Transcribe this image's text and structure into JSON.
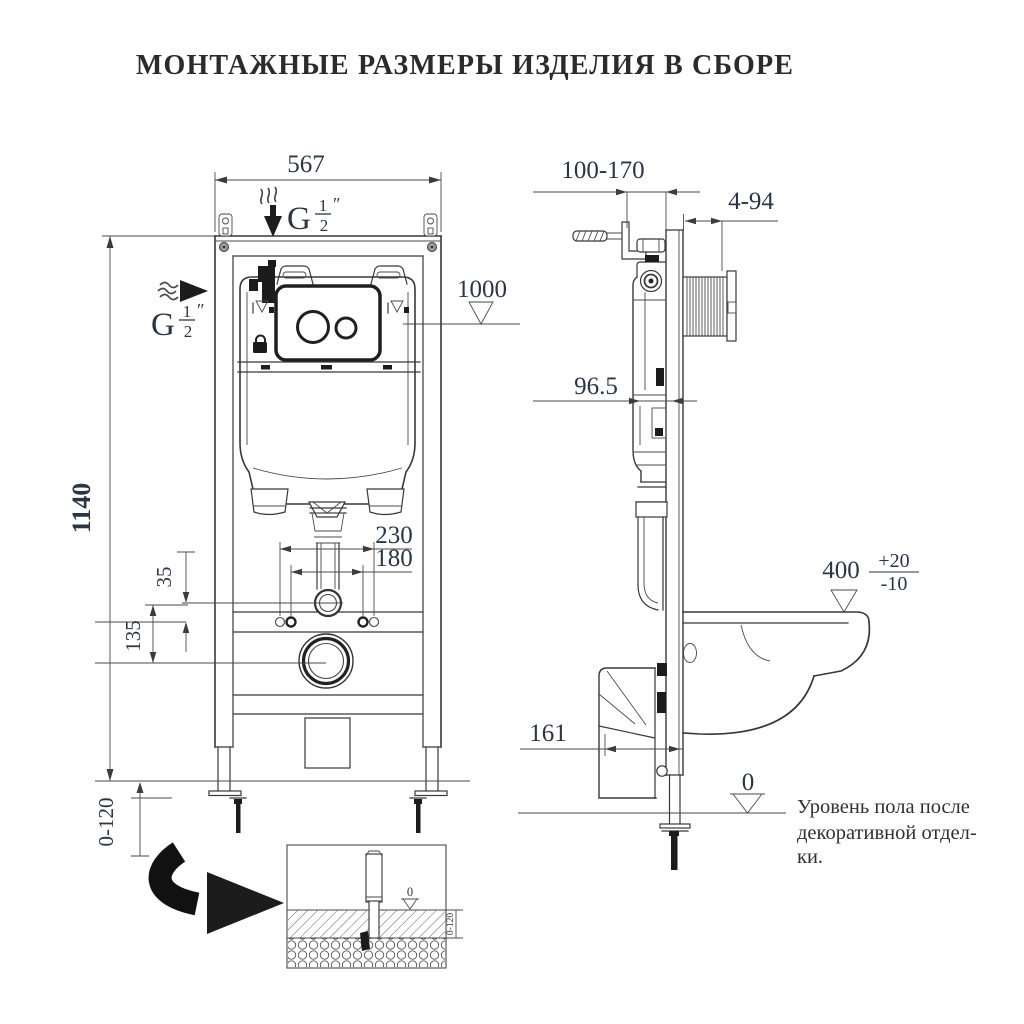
{
  "title": "МОНТАЖНЫЕ РАЗМЕРЫ ИЗДЕЛИЯ В СБОРЕ",
  "colors": {
    "line": "#383838",
    "dim_text": "#2a3646",
    "title_text": "#2b2b2b"
  },
  "front_view": {
    "dim_width_top": "567",
    "dim_plate_height": "1000",
    "dim_total_height": "1140",
    "dim_bolt_spacing_outer": "230",
    "dim_bolt_spacing_inner": "180",
    "dim_offset_35": "35",
    "dim_offset_135": "135",
    "dim_leg_adjust": "0-120",
    "inlet_top_label": {
      "letter": "G",
      "num": "1",
      "den": "2",
      "unit": "″"
    },
    "inlet_side_label": {
      "letter": "G",
      "num": "1",
      "den": "2",
      "unit": "″"
    }
  },
  "side_view": {
    "dim_depth_range": "100-170",
    "dim_finish_range": "4-94",
    "dim_cistern_depth": "96.5",
    "dim_bowl_height": "400",
    "dim_bowl_height_tol_plus": "+20",
    "dim_bowl_height_tol_minus": "-10",
    "dim_outlet_depth": "161",
    "floor_zero": "0",
    "floor_note": [
      "Уровень пола после",
      "декоративной отдел-",
      "ки."
    ]
  },
  "inset": {
    "zero_label": "0",
    "dim_leg_adjust": "0-120"
  }
}
